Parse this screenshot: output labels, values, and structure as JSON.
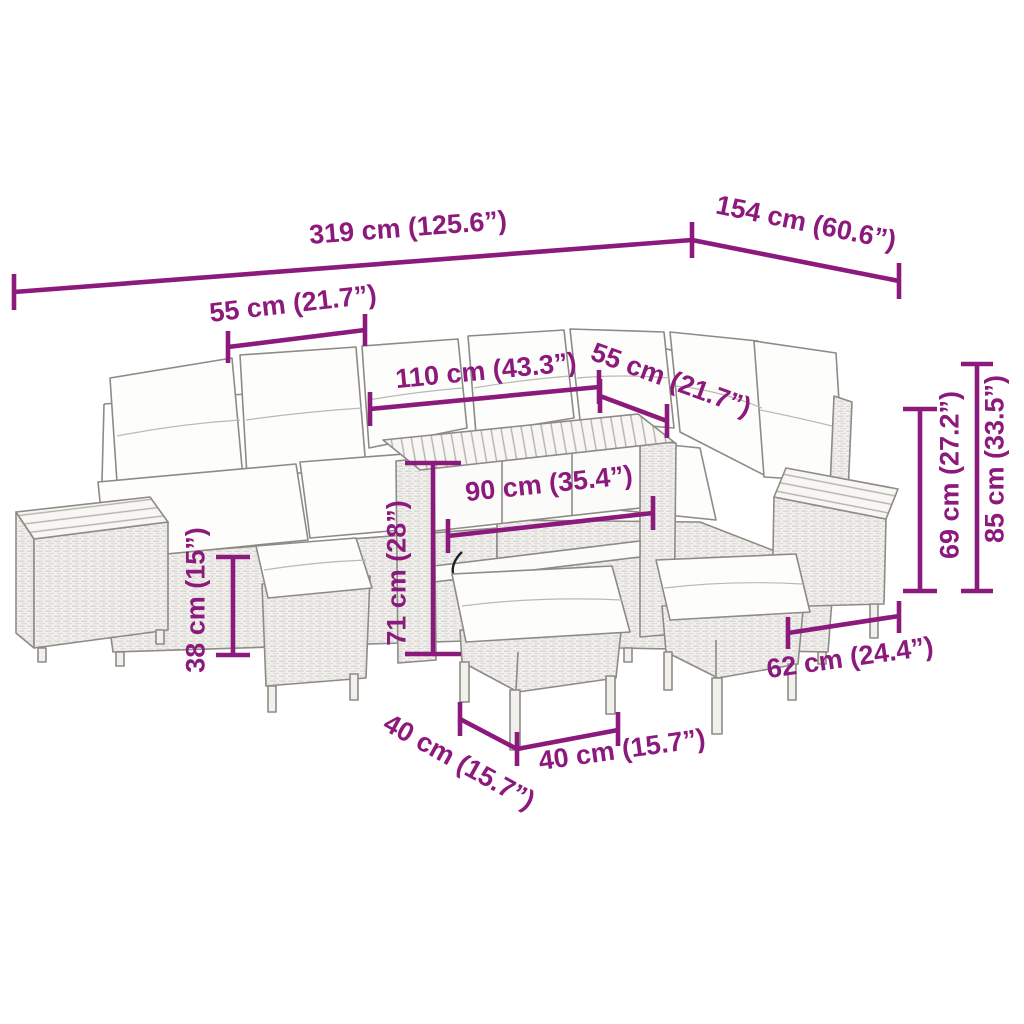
{
  "accent_color": "#8C1A7D",
  "drawing_color": "#8E8B86",
  "illustration": {
    "type": "line-drawing",
    "subject": "poly rattan garden corner sofa set with wood-top side tables, dining table, three cushioned stools and white cushions"
  },
  "dimensions": [
    {
      "id": "total-width",
      "label": "319 cm (125.6”)"
    },
    {
      "id": "total-depth",
      "label": "154 cm (60.6”)"
    },
    {
      "id": "seat-width-left",
      "label": "55 cm (21.7”)"
    },
    {
      "id": "table-length",
      "label": "110 cm (43.3”)"
    },
    {
      "id": "seat-depth-right",
      "label": "55 cm (21.7”)"
    },
    {
      "id": "table-width",
      "label": "90 cm (35.4”)"
    },
    {
      "id": "table-height",
      "label": "71 cm (28”)"
    },
    {
      "id": "stool-height",
      "label": "38 cm (15”)"
    },
    {
      "id": "module-width",
      "label": "62 cm (24.4”)"
    },
    {
      "id": "back-height",
      "label": "69 cm (27.2”)"
    },
    {
      "id": "total-height",
      "label": "85 cm (33.5”)"
    },
    {
      "id": "stool-depth",
      "label": "40 cm (15.7”)"
    },
    {
      "id": "stool-width",
      "label": "40 cm (15.7”)"
    }
  ]
}
